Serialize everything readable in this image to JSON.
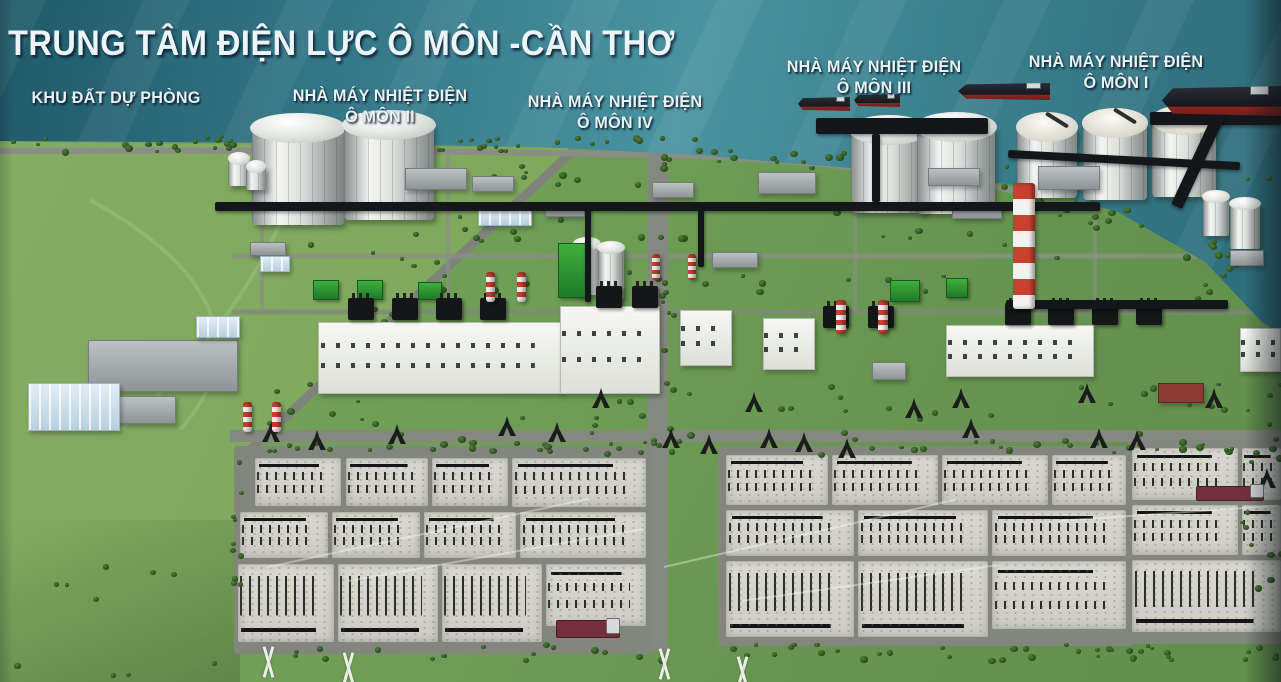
{
  "title": "TRUNG TÂM ĐIỆN LỰC Ô MÔN -CẦN THƠ",
  "labels": {
    "reserve_land": "KHU ĐẤT DỰ PHÒNG",
    "plant_ii": {
      "line1": "NHÀ MÁY NHIỆT ĐIỆN",
      "line2": "Ô MÔN II"
    },
    "plant_iv": {
      "line1": "NHÀ MÁY NHIỆT ĐIỆN",
      "line2": "Ô MÔN IV"
    },
    "plant_iii": {
      "line1": "NHÀ MÁY NHIỆT ĐIỆN",
      "line2": "Ô MÔN III"
    },
    "plant_i": {
      "line1": "NHÀ MÁY NHIỆT ĐIỆN",
      "line2": "Ô MÔN I"
    }
  },
  "colors": {
    "label_text": "#e9f3f5",
    "water_dark": "#1f5a68",
    "water_light": "#4a93a0",
    "land_green": "#6f9e56",
    "reserve_field_green": "#94b668",
    "tree_green": "#2f5a26",
    "switchyard_pad_gray": "#d8d8d2",
    "road_gray": "#85887f",
    "tank_white": "#eceeec",
    "chimney_red": "#c8402f",
    "equipment_black": "#141617",
    "ship_hull": "#15181c",
    "ship_waterline_red": "#8e2420",
    "truck_maroon": "#742e3d",
    "warehouse_blue": "#cfe3ee"
  }
}
